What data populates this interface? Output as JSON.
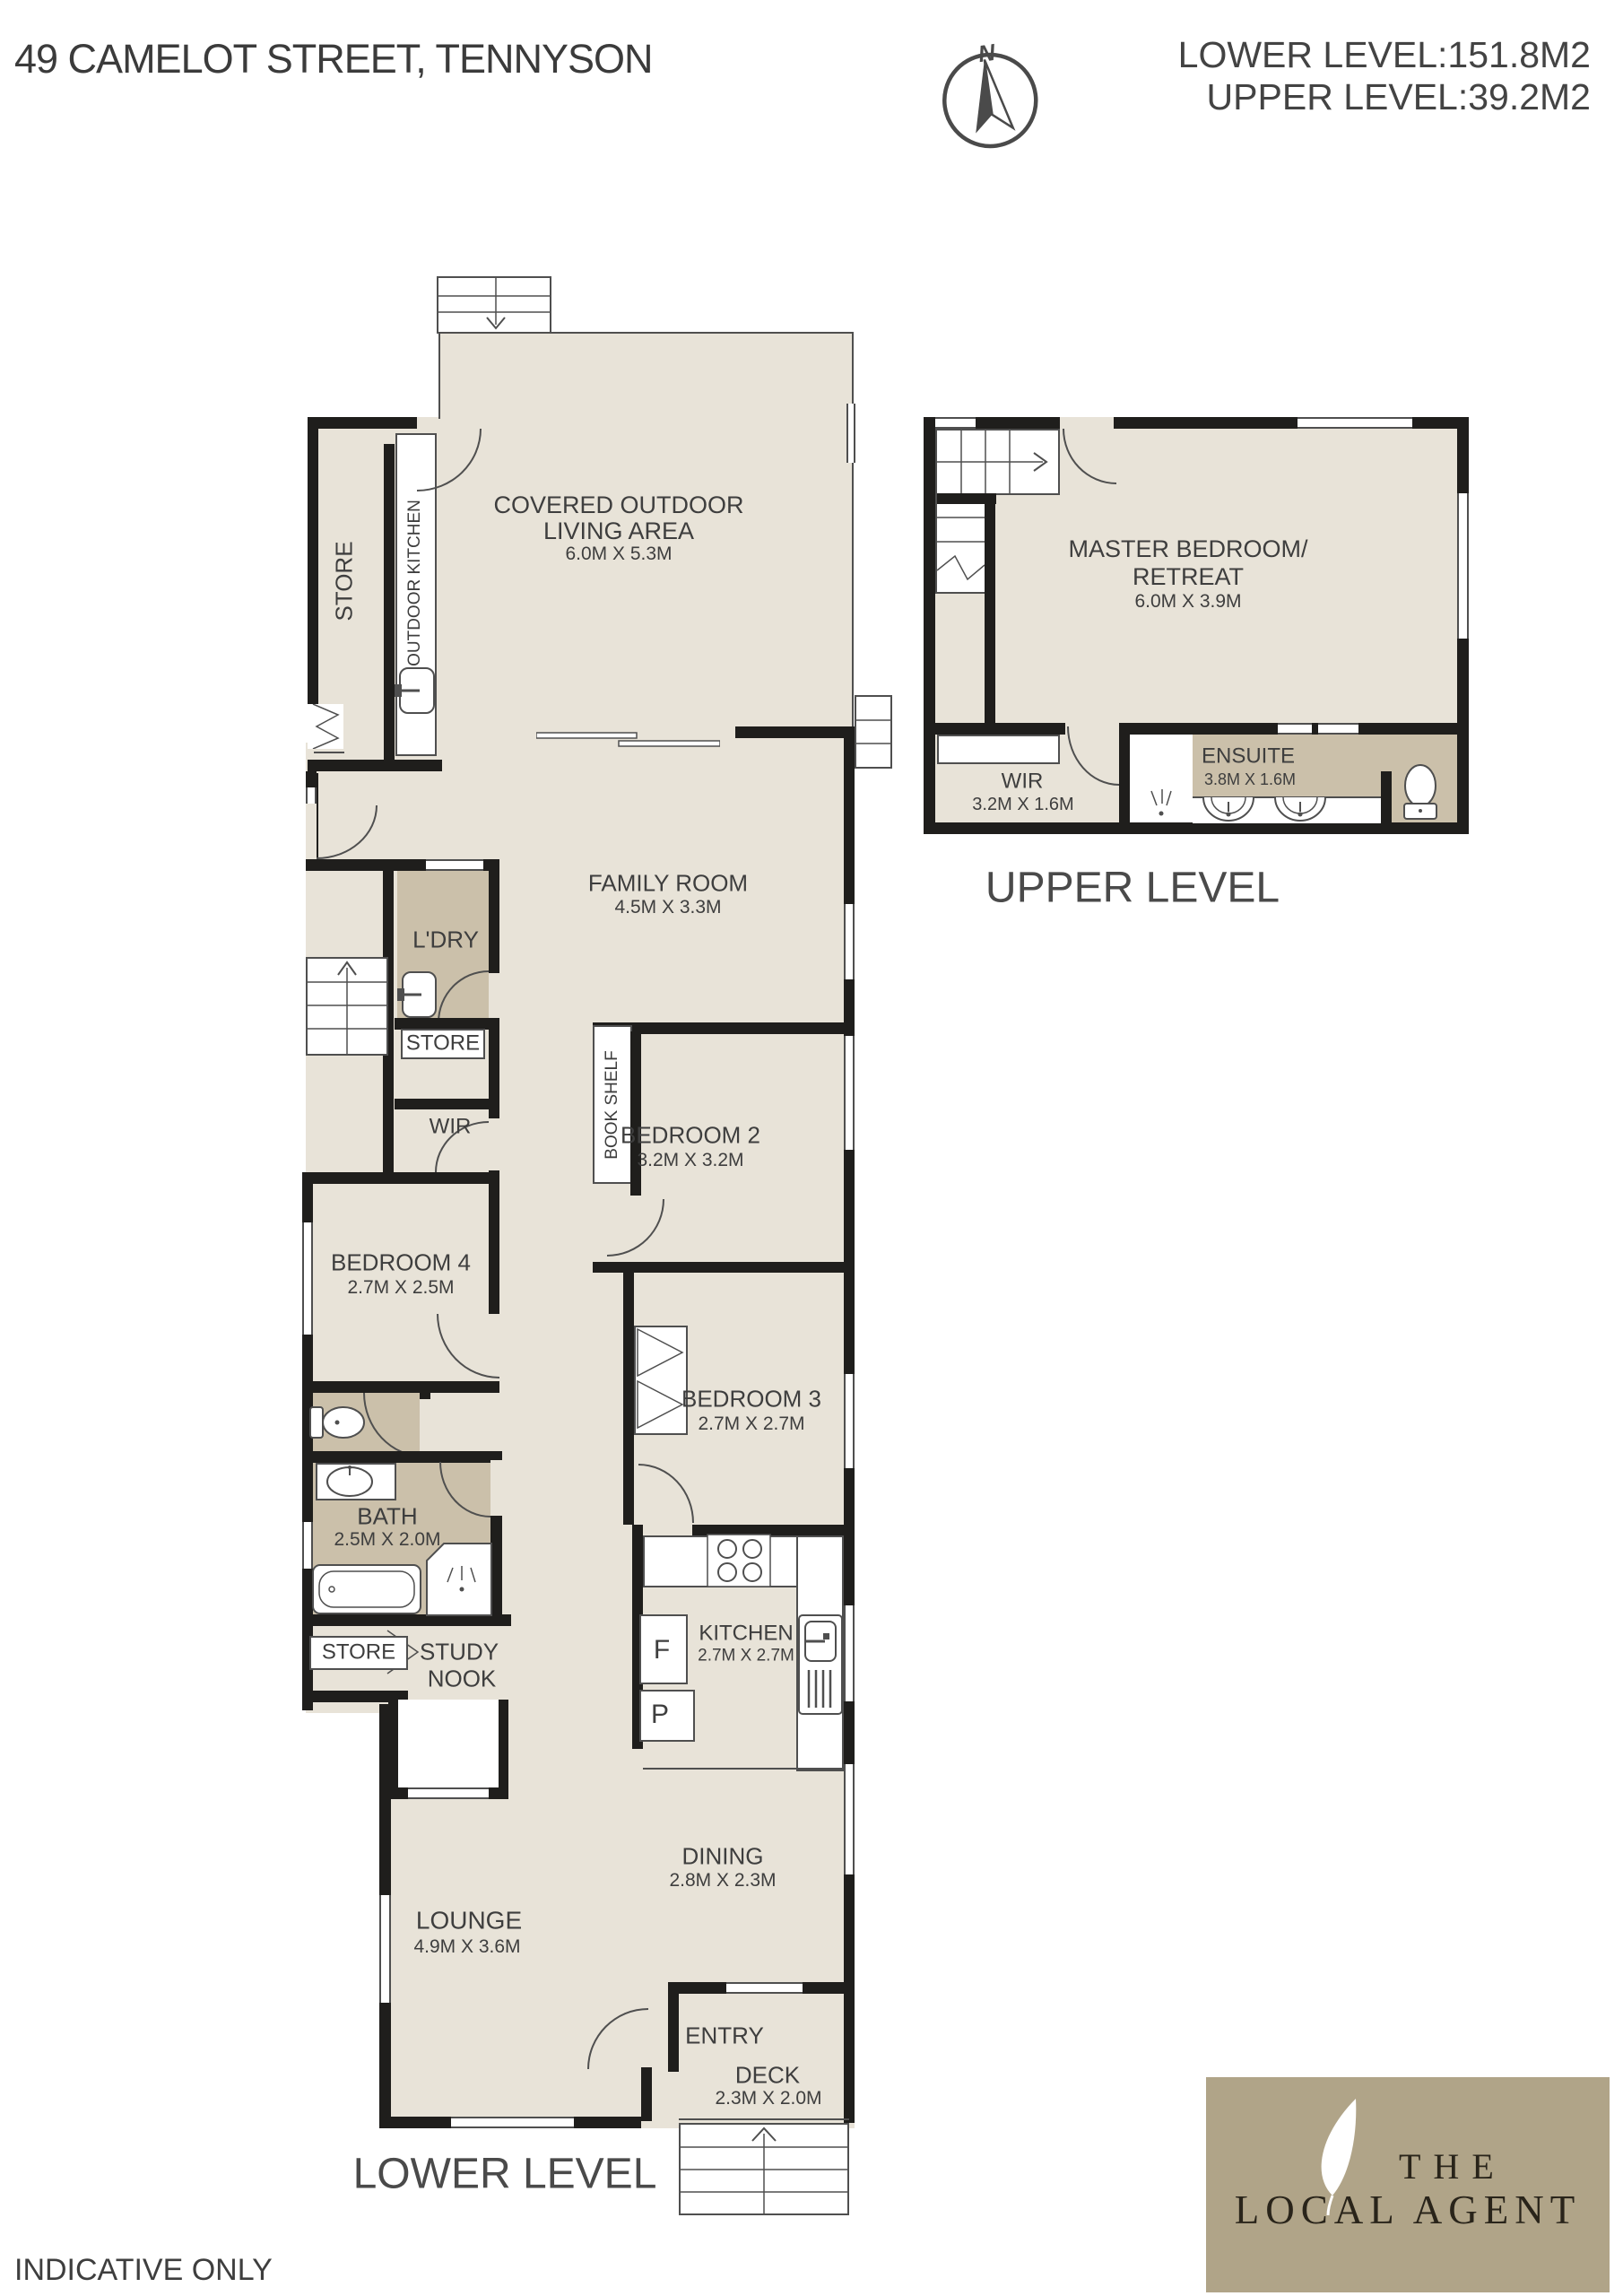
{
  "header": {
    "title": "49 CAMELOT STREET, TENNYSON",
    "area_line1": "LOWER LEVEL:151.8M2",
    "area_line2": "UPPER LEVEL:39.2M2",
    "compass_north": "N"
  },
  "lower": {
    "section_label": "LOWER LEVEL",
    "rooms": {
      "covered_outdoor": {
        "name1": "COVERED OUTDOOR",
        "name2": "LIVING AREA",
        "dims": "6.0M X 5.3M"
      },
      "store_top": {
        "name": "STORE"
      },
      "outdoor_kitchen": {
        "name": "OUTDOOR KITCHEN"
      },
      "family": {
        "name": "FAMILY ROOM",
        "dims": "4.5M X 3.3M"
      },
      "ldry": {
        "name": "L'DRY"
      },
      "store_mid": {
        "name": "STORE"
      },
      "wir": {
        "name": "WIR"
      },
      "book_shelf": {
        "name": "BOOK SHELF"
      },
      "bedroom2": {
        "name": "BEDROOM 2",
        "dims": "3.2M X 3.2M"
      },
      "bedroom4": {
        "name": "BEDROOM 4",
        "dims": "2.7M X 2.5M"
      },
      "bedroom3": {
        "name": "BEDROOM 3",
        "dims": "2.7M X 2.7M"
      },
      "bath": {
        "name": "BATH",
        "dims": "2.5M X 2.0M"
      },
      "store_bottom": {
        "name": "STORE"
      },
      "study_nook": {
        "name1": "STUDY",
        "name2": "NOOK"
      },
      "kitchen": {
        "name": "KITCHEN",
        "dims": "2.7M X 2.7M",
        "fridge": "F",
        "pantry": "P"
      },
      "dining": {
        "name": "DINING",
        "dims": "2.8M X 2.3M"
      },
      "lounge": {
        "name": "LOUNGE",
        "dims": "4.9M X 3.6M"
      },
      "entry": {
        "name": "ENTRY"
      },
      "deck": {
        "name": "DECK",
        "dims": "2.3M X 2.0M"
      }
    }
  },
  "upper": {
    "section_label": "UPPER LEVEL",
    "rooms": {
      "master": {
        "name1": "MASTER BEDROOM/",
        "name2": "RETREAT",
        "dims": "6.0M X 3.9M"
      },
      "wir": {
        "name": "WIR",
        "dims": "3.2M X 1.6M"
      },
      "ensuite": {
        "name": "ENSUITE",
        "dims": "3.8M X 1.6M"
      }
    }
  },
  "footer": {
    "disclaimer": "INDICATIVE ONLY"
  },
  "logo": {
    "line1": "THE",
    "line2": "LOCAL AGENT"
  },
  "colors": {
    "wall": "#1f1e1c",
    "floor": "#e8e3d8",
    "wet": "#cbc0aa",
    "line": "#4f4f4f",
    "logo_bg": "#b0a488",
    "text": "#3e3e3e"
  }
}
